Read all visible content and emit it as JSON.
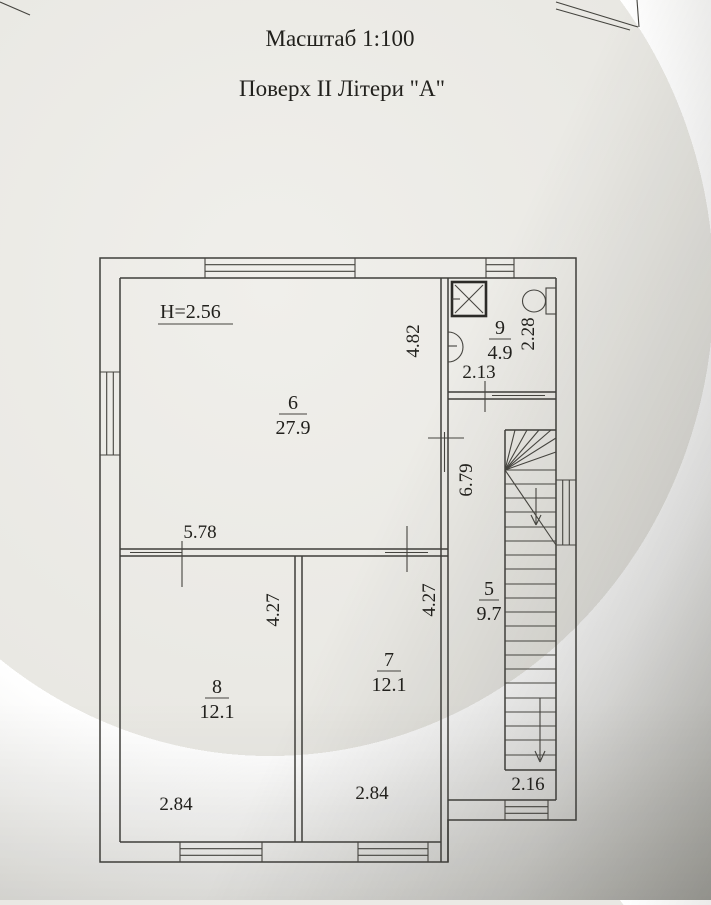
{
  "document": {
    "scale_title": "Масштаб 1:100",
    "floor_title": "Поверх II Літери \"А\"",
    "ceiling_height": "H=2.56"
  },
  "rooms": {
    "room6": {
      "number": "6",
      "area": "27.9"
    },
    "room7": {
      "number": "7",
      "area": "12.1"
    },
    "room8": {
      "number": "8",
      "area": "12.1"
    },
    "room9": {
      "number": "9",
      "area": "4.9"
    },
    "room5": {
      "number": "5",
      "area": "9.7"
    }
  },
  "dimensions": {
    "room6_width": "5.78",
    "room6_depth": "4.82",
    "room9_width": "2.13",
    "room9_depth": "2.28",
    "hall_length": "6.79",
    "room8_depth": "4.27",
    "room7_depth": "4.27",
    "room8_width": "2.84",
    "room7_width": "2.84",
    "stairhall_width": "2.16"
  },
  "colors": {
    "ink": "#3f3e3a",
    "paper_light": "#efeeea",
    "paper_dark": "#b4b3ad"
  }
}
